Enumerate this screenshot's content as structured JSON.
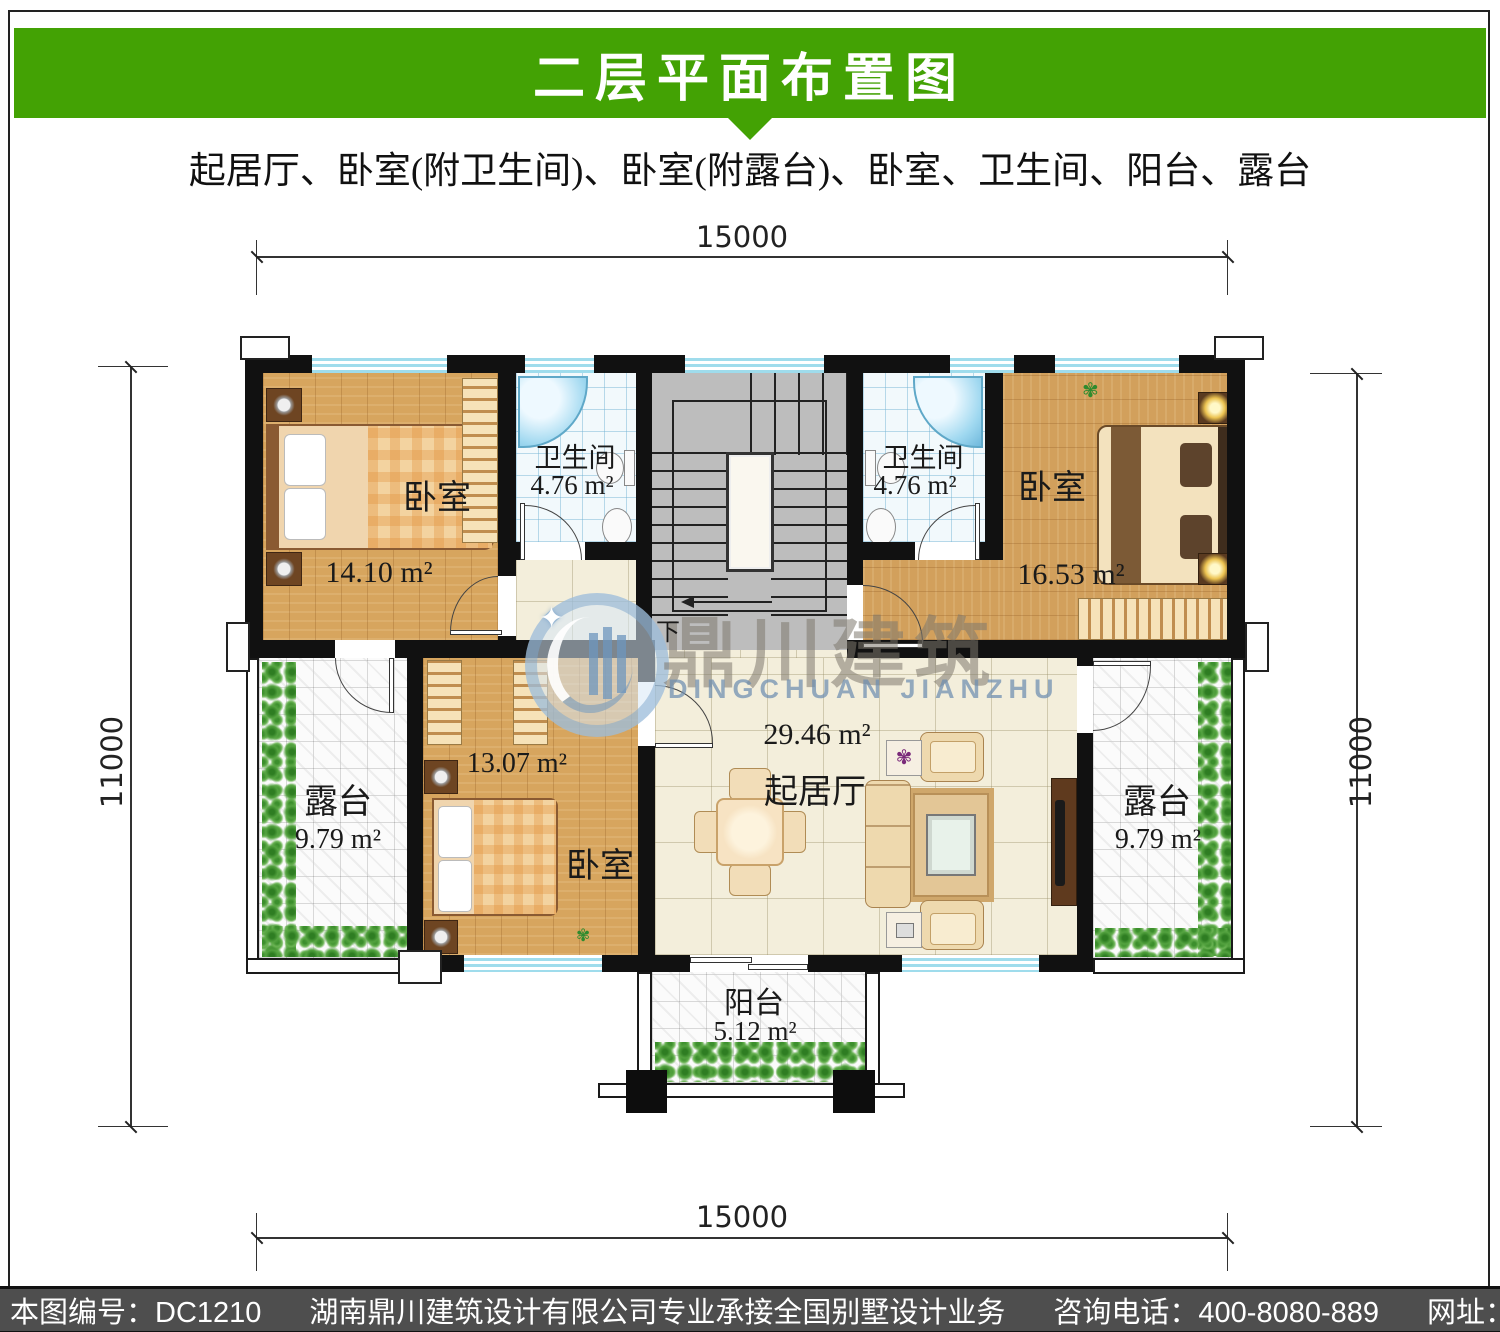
{
  "header": {
    "title": "二层平面布置图"
  },
  "subtitle": "起居厅、卧室(附卫生间)、卧室(附露台)、卧室、卫生间、阳台、露台",
  "dims": {
    "top": "15000",
    "bottom": "15000",
    "left": "11000",
    "right": "11000"
  },
  "rooms": {
    "bedroom_tl": {
      "name": "卧室",
      "area": "14.10 m²"
    },
    "bath_left": {
      "name": "卫生间",
      "area": "4.76 m²"
    },
    "bath_right": {
      "name": "卫生间",
      "area": "4.76 m²"
    },
    "bedroom_tr": {
      "name": "卧室",
      "area": "16.53 m²"
    },
    "bedroom_mid": {
      "name": "卧室",
      "area": "13.07 m²"
    },
    "living": {
      "name": "起居厅",
      "area": "29.46 m²"
    },
    "terrace_left": {
      "name": "露台",
      "area": "9.79 m²"
    },
    "terrace_right": {
      "name": "露台",
      "area": "9.79 m²"
    },
    "balcony": {
      "name": "阳台",
      "area": "5.12 m²"
    }
  },
  "stairs": {
    "down_label": "下"
  },
  "watermark": {
    "cn": "鼎川建筑",
    "en": "DINGCHUAN JIANZHU"
  },
  "footer": {
    "part1": "本图编号：DC1210",
    "part2": "湖南鼎川建筑设计有限公司专业承接全国别墅设计业务",
    "part3": "咨询电话：400-8080-889",
    "part4": "网址：www.bstzcs.com"
  },
  "colors": {
    "header_green": "#43A204",
    "footer_bg": "#4E4E4E",
    "wall": "#111111",
    "wood": "#D7A55E",
    "bath_blue": "#9FDCEC"
  }
}
